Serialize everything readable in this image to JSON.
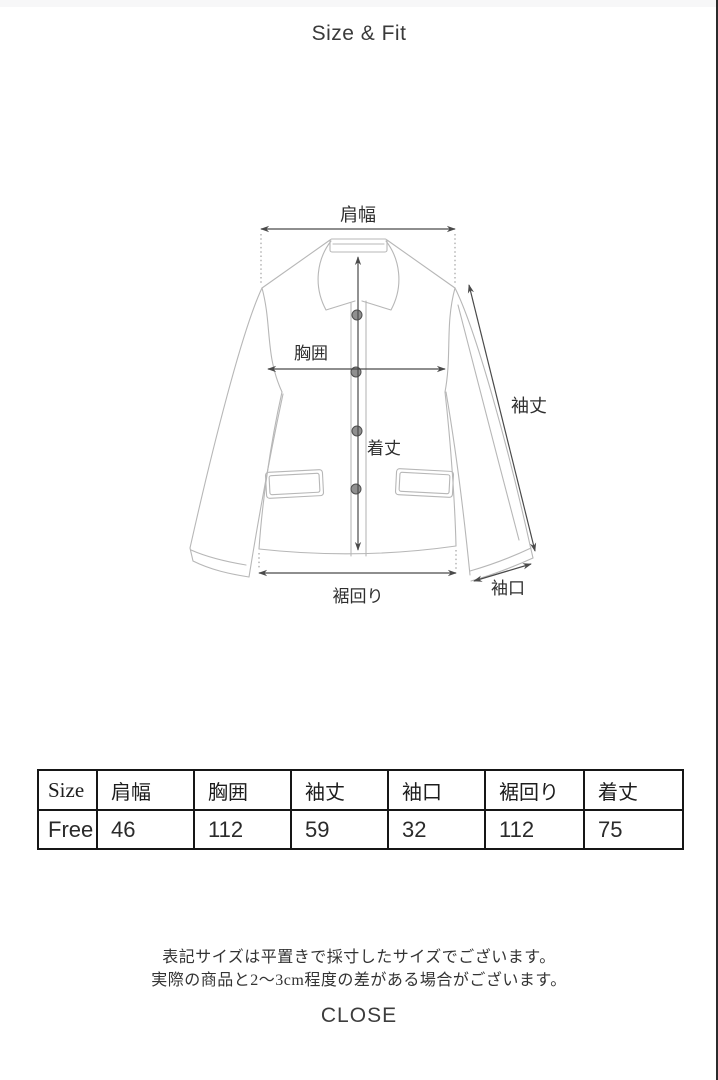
{
  "page": {
    "title": "Size & Fit",
    "close_label": "CLOSE"
  },
  "diagram": {
    "labels": {
      "shoulder_width": "肩幅",
      "chest": "胸囲",
      "body_length": "着丈",
      "sleeve_length": "袖丈",
      "cuff_width": "袖口",
      "hem_width": "裾回り"
    }
  },
  "size_table": {
    "headers": [
      "Size",
      "肩幅",
      "胸囲",
      "袖丈",
      "袖口",
      "裾回り",
      "着丈"
    ],
    "rows": [
      [
        "Free",
        "46",
        "112",
        "59",
        "32",
        "112",
        "75"
      ]
    ]
  },
  "notes": {
    "line1": "表記サイズは平置きで採寸したサイズでございます。",
    "line2": "実際の商品と2〜3cm程度の差がある場合がございます。"
  }
}
